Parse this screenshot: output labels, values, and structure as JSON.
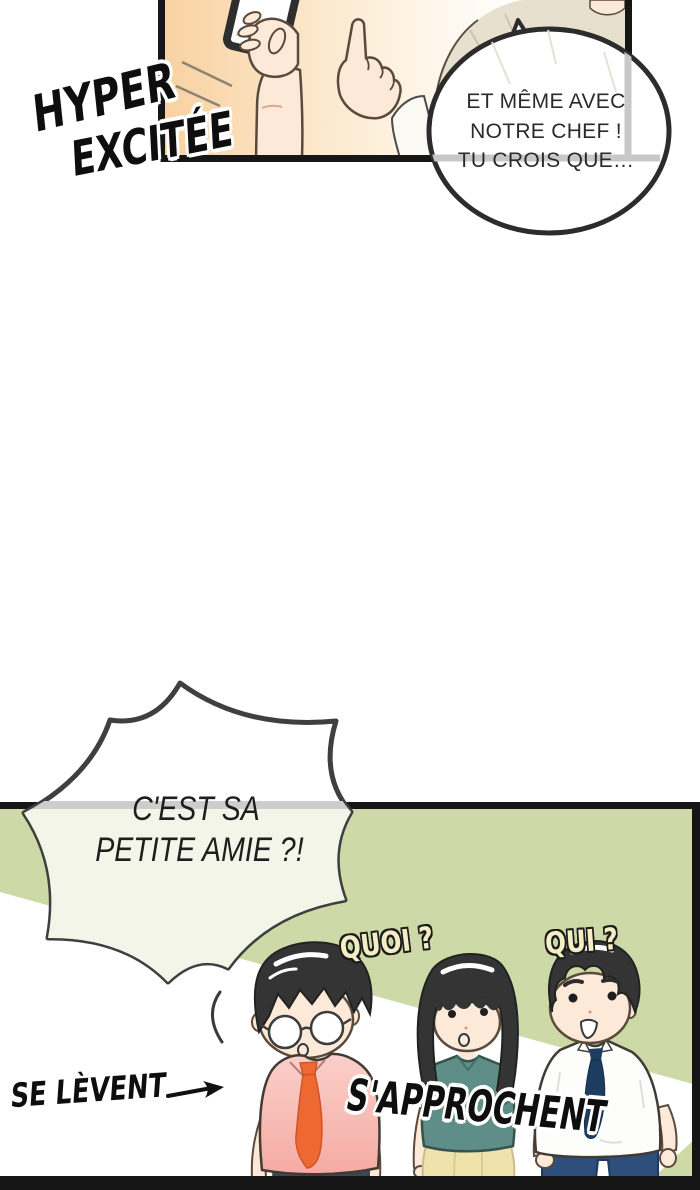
{
  "colors": {
    "panel_green": "#cdd9a6",
    "ink": "#161616",
    "skin": "#fce9d8",
    "pink_shirt": "#f5aba4",
    "orange_tie": "#ee6831",
    "teal_shirt": "#5f8e89",
    "navy_tie": "#1d3c5f",
    "boy_pants": "#2e4e7c",
    "skirt_yellow": "#f0e2ab",
    "beige_shirt": "#e7e0ce",
    "warm_glow": "#f8d1a0",
    "sfx_cream": "#f3eec5",
    "hair": "#343434"
  },
  "sfx": {
    "hyper": "HYPER",
    "excitee": "EXCITÉE",
    "quoi": "QUOI ?",
    "qui": "QUI ?"
  },
  "speech_bubble": {
    "line1": "ET MÊME AVEC",
    "line2": "NOTRE CHEF !",
    "line3": "TU CROIS QUE…"
  },
  "burst_bubble": {
    "line1": "C'EST SA",
    "line2": "PETITE AMIE ?!"
  },
  "captions": {
    "se_levent": "SE LÈVENT",
    "s_approchent": "S'APPROCHENT"
  }
}
